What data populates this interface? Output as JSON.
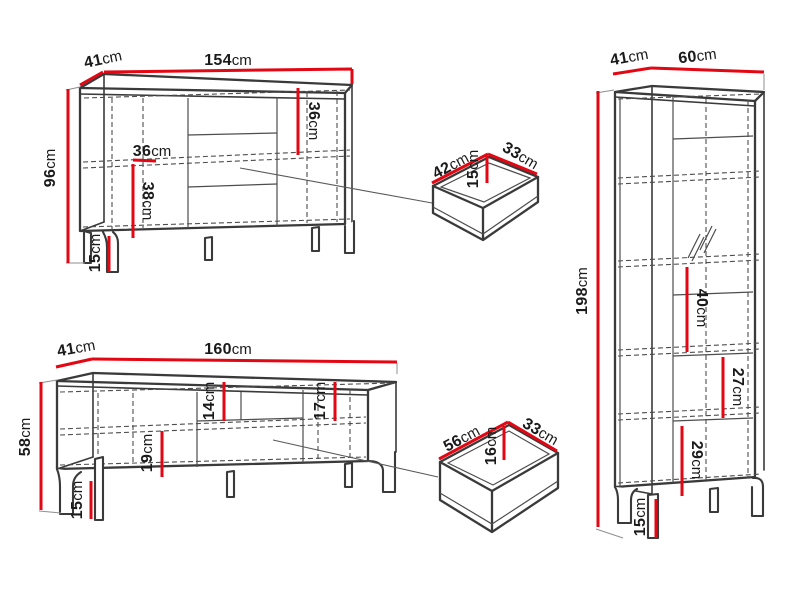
{
  "palette": {
    "dimension_red": "#e30613",
    "outline_dark": "#3a3a3a",
    "line_gray": "#4d4d4d",
    "extension_gray": "#8f8f8f",
    "text_black": "#1a1a1a",
    "background": "#ffffff"
  },
  "sideboard": {
    "dims": {
      "depth": {
        "value": "41",
        "unit": "cm"
      },
      "width": {
        "value": "154",
        "unit": "cm"
      },
      "height": {
        "value": "96",
        "unit": "cm"
      },
      "interior_width": {
        "value": "36",
        "unit": "cm"
      },
      "interior_height": {
        "value": "38",
        "unit": "cm"
      },
      "leg_height": {
        "value": "15",
        "unit": "cm"
      },
      "right_interior_height": {
        "value": "36",
        "unit": "cm"
      }
    }
  },
  "drawer_small": {
    "dims": {
      "depth": {
        "value": "42",
        "unit": "cm"
      },
      "height": {
        "value": "15",
        "unit": "cm"
      },
      "width": {
        "value": "33",
        "unit": "cm"
      }
    }
  },
  "tv_stand": {
    "dims": {
      "depth": {
        "value": "41",
        "unit": "cm"
      },
      "width": {
        "value": "160",
        "unit": "cm"
      },
      "height": {
        "value": "58",
        "unit": "cm"
      },
      "niche_height": {
        "value": "14",
        "unit": "cm"
      },
      "left_interior_height": {
        "value": "19",
        "unit": "cm"
      },
      "right_interior_height": {
        "value": "17",
        "unit": "cm"
      },
      "leg_height": {
        "value": "15",
        "unit": "cm"
      }
    }
  },
  "drawer_large": {
    "dims": {
      "depth": {
        "value": "56",
        "unit": "cm"
      },
      "height": {
        "value": "16",
        "unit": "cm"
      },
      "width": {
        "value": "33",
        "unit": "cm"
      }
    }
  },
  "cabinet": {
    "dims": {
      "depth": {
        "value": "41",
        "unit": "cm"
      },
      "width": {
        "value": "60",
        "unit": "cm"
      },
      "height": {
        "value": "198",
        "unit": "cm"
      },
      "upper_shelf_height": {
        "value": "40",
        "unit": "cm"
      },
      "middle_shelf_height": {
        "value": "27",
        "unit": "cm"
      },
      "lower_shelf_height": {
        "value": "29",
        "unit": "cm"
      },
      "leg_height": {
        "value": "15",
        "unit": "cm"
      }
    }
  }
}
